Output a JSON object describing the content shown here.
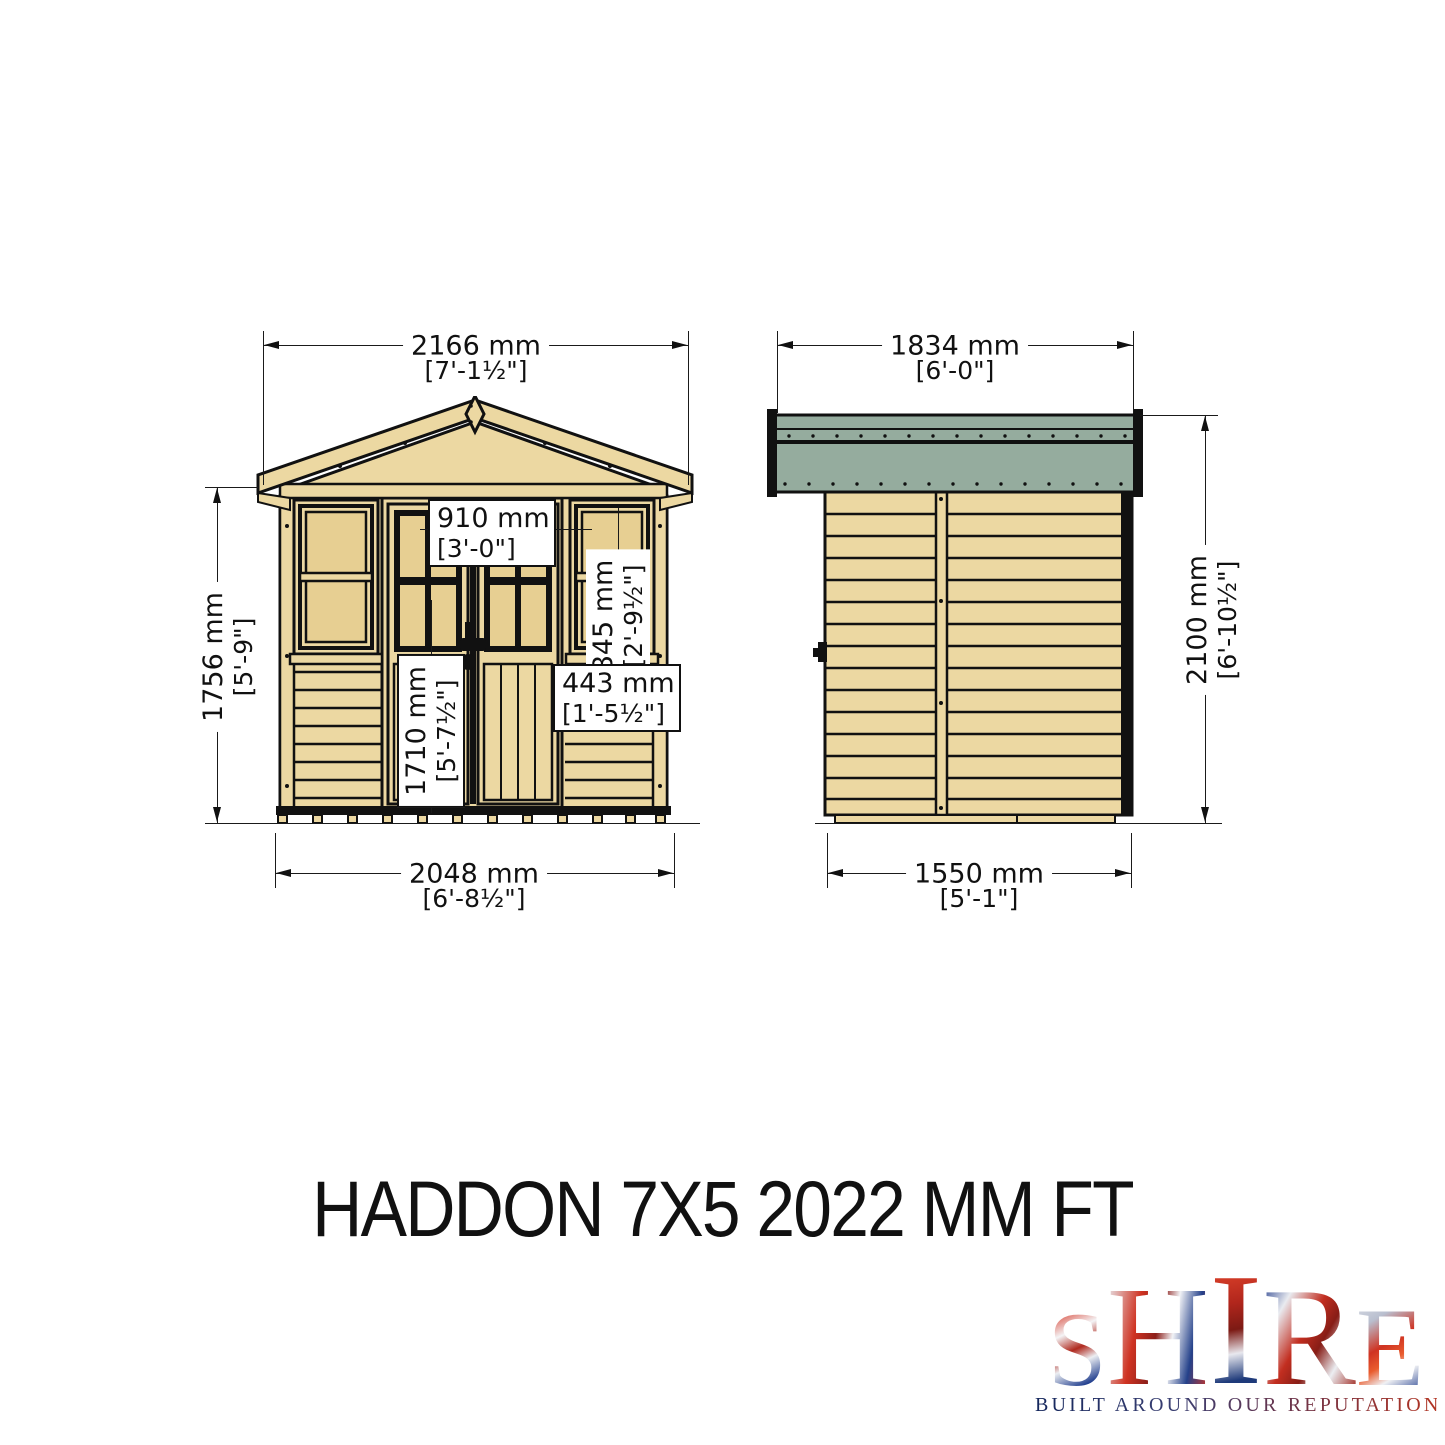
{
  "title": "HADDON 7X5 2022 MM FT",
  "front_elevation": {
    "dims": {
      "roof_width": {
        "mm": "2166 mm",
        "ft": "[7'-1½\"]"
      },
      "eaves_height": {
        "mm": "1756 mm",
        "ft": "[5'-9\"]"
      },
      "door_width": {
        "mm": "910 mm",
        "ft": "[3'-0\"]"
      },
      "window_height": {
        "mm": "845 mm",
        "ft": "[2'-9½\"]"
      },
      "door_height": {
        "mm": "1710 mm",
        "ft": "[5'-7½\"]"
      },
      "window_width": {
        "mm": "443 mm",
        "ft": "[1'-5½\"]"
      },
      "base_width": {
        "mm": "2048 mm",
        "ft": "[6'-8½\"]"
      }
    }
  },
  "side_elevation": {
    "dims": {
      "roof_depth": {
        "mm": "1834 mm",
        "ft": "[6'-0\"]"
      },
      "ridge_height": {
        "mm": "2100 mm",
        "ft": "[6'-10½\"]"
      },
      "base_depth": {
        "mm": "1550 mm",
        "ft": "[5'-1\"]"
      }
    }
  },
  "logo": {
    "letters": [
      "S",
      "H",
      "I",
      "R",
      "E"
    ],
    "tagline": "BUILT AROUND OUR REPUTATION"
  },
  "colors": {
    "wood": "#ecd8a2",
    "wood_panel": "#e7cf92",
    "roof_felt": "#95ac9e",
    "line": "#111111"
  }
}
